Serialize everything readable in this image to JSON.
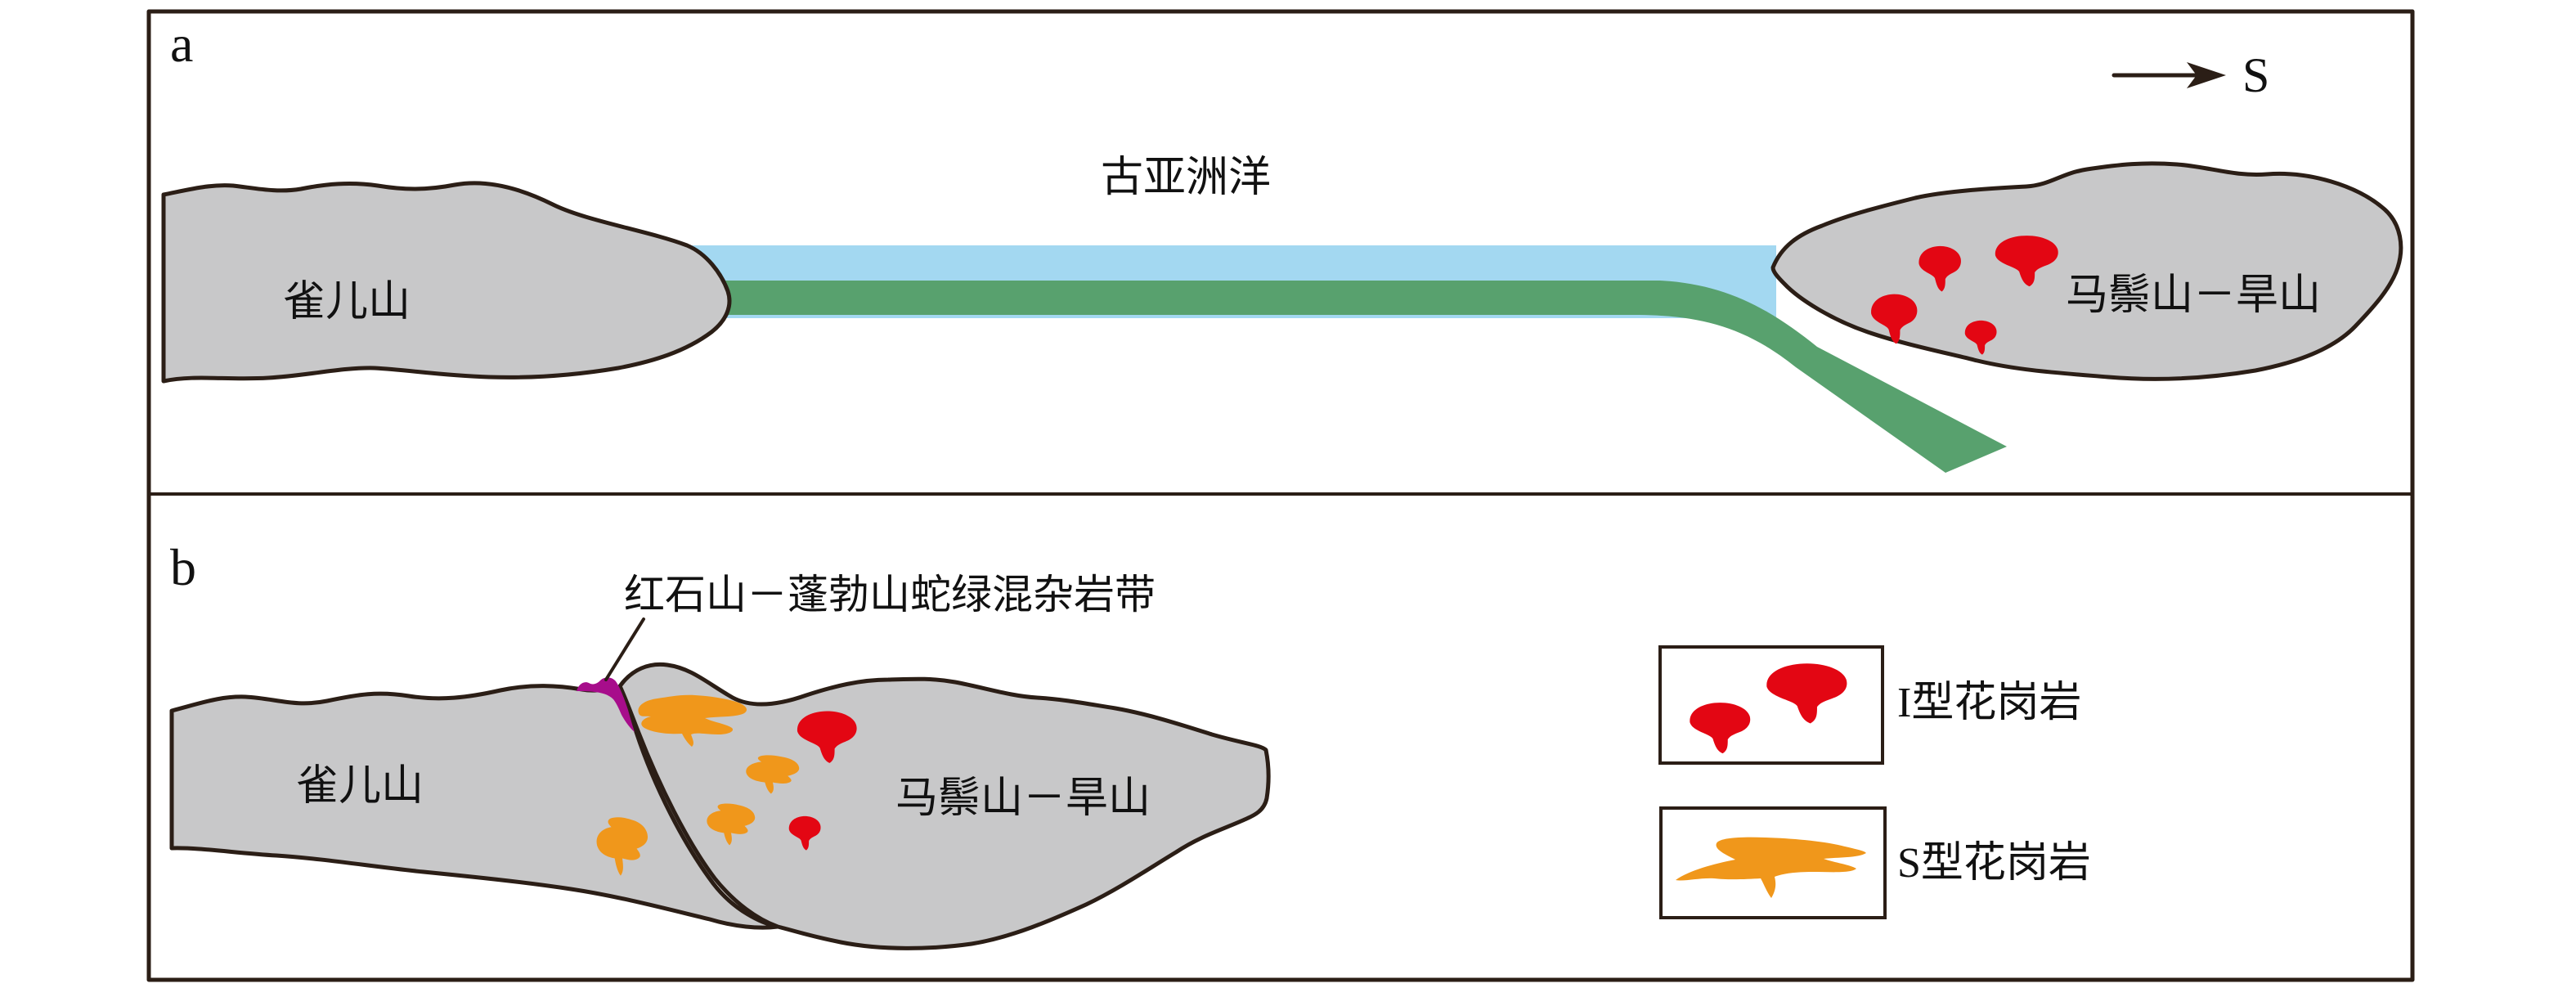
{
  "figure": {
    "type": "tectonic-evolution-cartoon",
    "panels": [
      "a",
      "b"
    ]
  },
  "panel_a": {
    "label": "a",
    "direction_label": "S",
    "ocean_label": "古亚洲洋",
    "left_continent_label": "雀儿山",
    "right_continent_label": "马鬃山－旱山",
    "i_type_granite_count": 4
  },
  "panel_b": {
    "label": "b",
    "suture_label": "红石山－蓬勃山蛇绿混杂岩带",
    "left_continent_label": "雀儿山",
    "right_continent_label": "马鬃山－旱山",
    "i_type_granite_count": 2,
    "s_type_granite_count": 4
  },
  "legend": {
    "items": [
      {
        "label": "I型花岗岩",
        "swatch": "i-type-granite-red-blobs"
      },
      {
        "label": "S型花岗岩",
        "swatch": "s-type-granite-orange-sill"
      }
    ]
  },
  "colors": {
    "continent_gray": "#c8c8c9",
    "outline_dark": "#2b1e16",
    "ocean_blue": "#a3d8f1",
    "slab_green": "#58a16e",
    "granite_i_red": "#e30613",
    "granite_s_orange": "#f0971b",
    "ophiolite_purple": "#a70d8b"
  }
}
